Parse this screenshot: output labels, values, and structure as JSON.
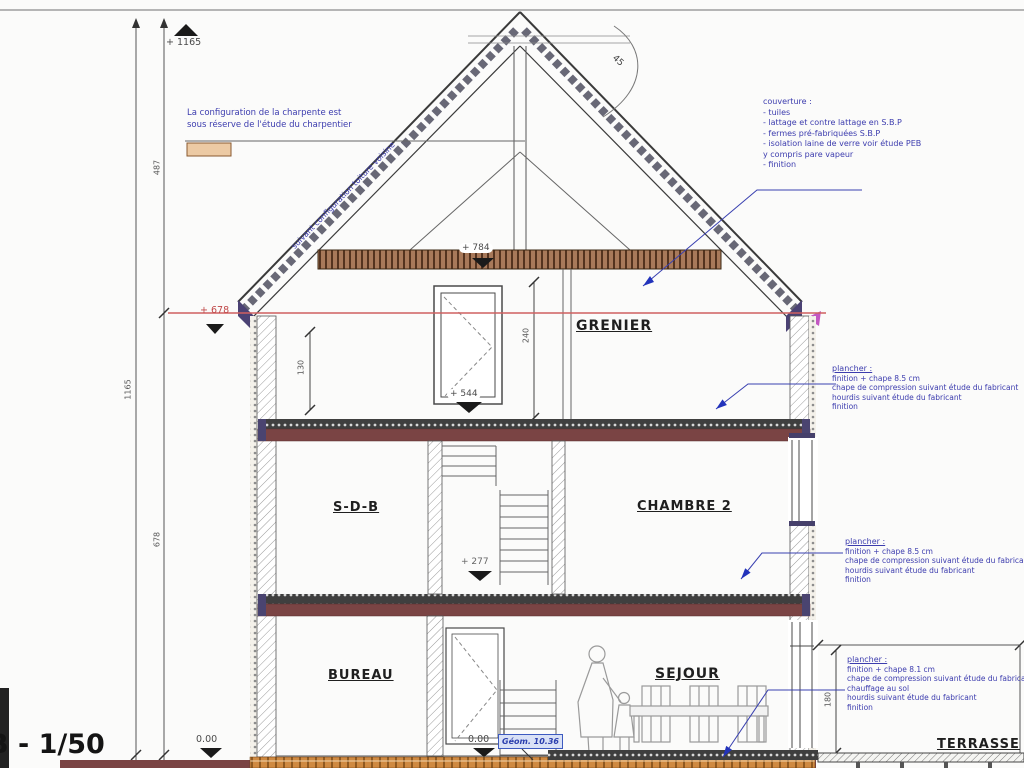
{
  "scale_label": "B - 1/50",
  "rooms": {
    "grenier": "GRENIER",
    "sdb": "S-D-B",
    "chambre2": "CHAMBRE 2",
    "bureau": "BUREAU",
    "sejour": "SEJOUR",
    "terrasse": "TERRASSE"
  },
  "levels": {
    "ridge": "+ 1165",
    "attic_slab": "+ 784",
    "eave": "+ 678",
    "grenier_floor": "+ 544",
    "first_floor": "+ 277",
    "ground": "0.00",
    "geom": "Géom. 10.36"
  },
  "dims": {
    "total": "1165",
    "roof": "487",
    "walls": "678",
    "knee": "130",
    "grenier": "240",
    "terrace": "180",
    "angle": "45"
  },
  "notes": {
    "charpente_1": "La configuration de la charpente est",
    "charpente_2": "sous réserve de l'étude du charpentier",
    "roof_slope": "suivant configuration toiture voisine",
    "couverture": {
      "title": "couverture :",
      "items": [
        "- tuiles",
        "- lattage et contre lattage en S.B.P",
        "- fermes pré-fabriquées S.B.P",
        "- isolation laine de verre voir étude PEB",
        "y compris pare vapeur",
        "- finition"
      ]
    },
    "plancher_mid": {
      "title": "plancher :",
      "lines": [
        "finition + chape 8.5 cm",
        "chape de compression suivant étude du fabricant",
        "hourdis suivant étude du fabricant",
        "finition"
      ]
    },
    "plancher_bottom": {
      "title": "plancher :",
      "lines": [
        "finition + chape 8.1 cm",
        "chape de compression suivant étude du fabricant",
        "chauffage au sol",
        "hourdis suivant étude du fabricant",
        "finition"
      ]
    }
  },
  "colors": {
    "annotation_blue": "#3c3cae",
    "level_red": "#c04848",
    "slab_maroon": "#7a4444",
    "attic_brown": "#a8795a",
    "ground_orange": "#cf8a42"
  }
}
